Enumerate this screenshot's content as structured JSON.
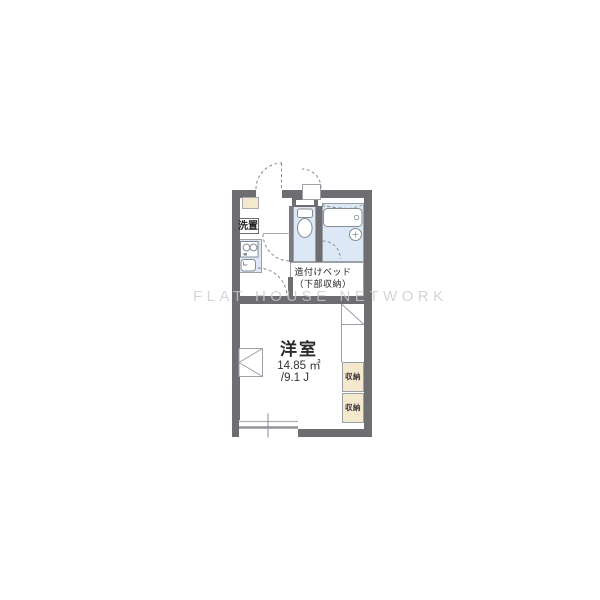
{
  "plan": {
    "watermark": "FLAT HOUSE NETWORK",
    "rooms": {
      "main_room": {
        "name": "洋室",
        "area_sqm": "14.85 ㎡",
        "area_tatami": "/9.1 J"
      },
      "built_in_bed": {
        "line1": "造付けベッド",
        "line2": "（下部収納）"
      },
      "laundry": {
        "label": "洗置"
      },
      "storage_upper": {
        "label": "収納"
      },
      "storage_lower": {
        "label": "収納"
      }
    },
    "fixtures": [
      "entrance-door",
      "outdoor-closet-door",
      "shoe-box",
      "washing-machine-space",
      "stove",
      "kitchen-sink",
      "toilet",
      "bathtub",
      "bath-drain",
      "folding-table",
      "refrigerator-space",
      "window"
    ],
    "colors": {
      "wall": "#6e6d72",
      "water_area": "#dce8f5",
      "storage_box": "#f4e9cd",
      "line": "#9aa0a8",
      "watermark": "#cbcbcb"
    }
  }
}
